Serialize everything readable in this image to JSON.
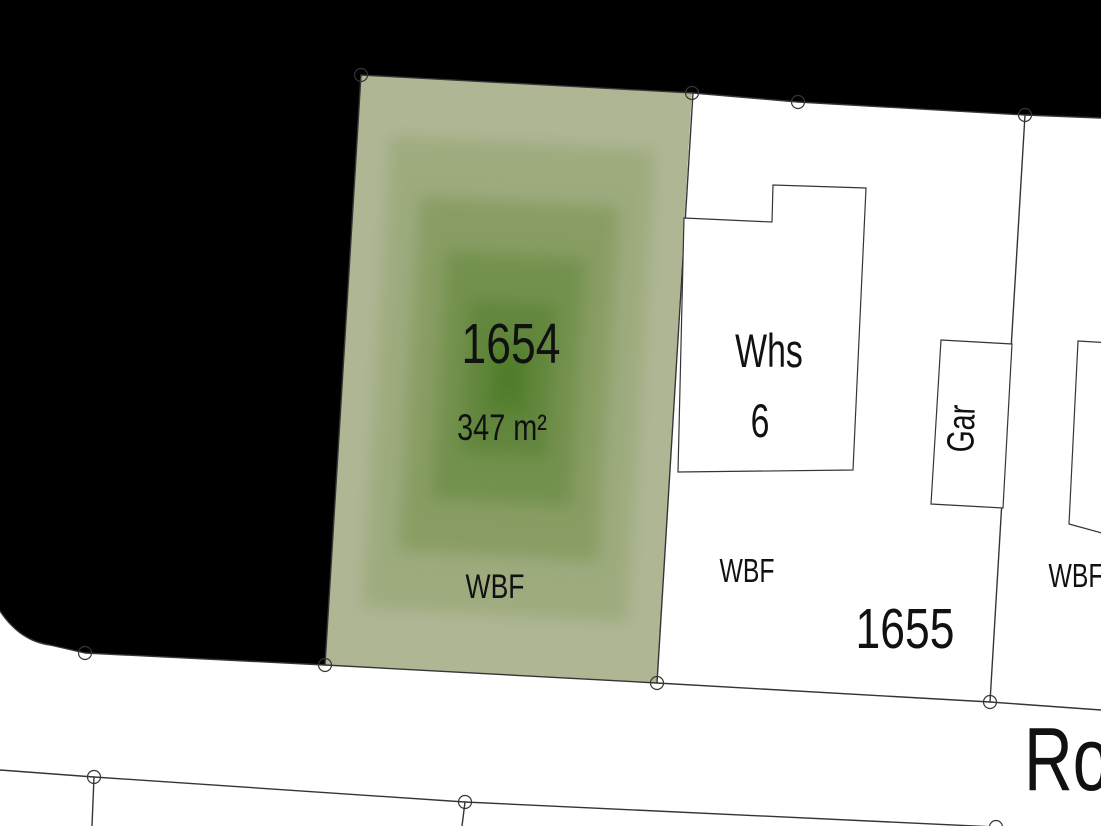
{
  "map": {
    "colors": {
      "outside_fill": "#000000",
      "road_fill": "#ffffff",
      "building_fill": "#ffffff",
      "line_color": "#353535",
      "label_color": "#111111",
      "parcel_fill_steps": [
        "#afb694",
        "#9dab7e",
        "#889d64",
        "#73914d",
        "#62863e",
        "#55802f",
        "#4e7a29"
      ]
    },
    "labels": {
      "parcel_main_number": "1654",
      "parcel_main_area": "347 m²",
      "parcel_main_usage": "WBF",
      "building_house_label": "Whs",
      "building_house_number": "6",
      "building_garage_label": "Gar",
      "parcel_neighbor_number": "1655",
      "parcel_neighbor_usage": "WBF",
      "parcel_right_usage": "WBF",
      "street_name_partial": "Ro"
    }
  }
}
